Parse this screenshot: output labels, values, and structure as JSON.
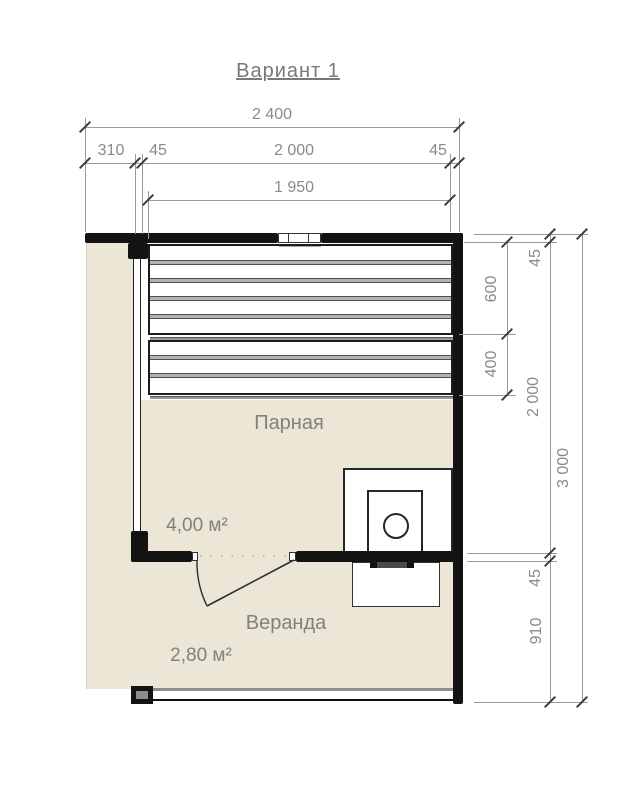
{
  "title": "Вариант 1",
  "rooms": [
    {
      "name": "Парная",
      "area": "4,00 м²"
    },
    {
      "name": "Веранда",
      "area": "2,80 м²"
    }
  ],
  "dimensions": {
    "top": {
      "total": "2 400",
      "deck": "310",
      "wall_left": "45",
      "width": "2 000",
      "wall_right": "45",
      "inner": "1 950"
    },
    "right": {
      "wall_top": "45",
      "bench_upper": "600",
      "bench_lower": "400",
      "room_depth": "2 000",
      "total": "3 000",
      "wall_bottom": "45",
      "veranda": "910"
    }
  },
  "colors": {
    "floor": "#ebe6d6",
    "wall": "#131313",
    "dimension": "#8a8a8a",
    "label": "#82827a"
  },
  "elements": {
    "window": "window",
    "door": "door-swing",
    "stove": "stove-with-chimney",
    "benches": "slatted-benches"
  }
}
